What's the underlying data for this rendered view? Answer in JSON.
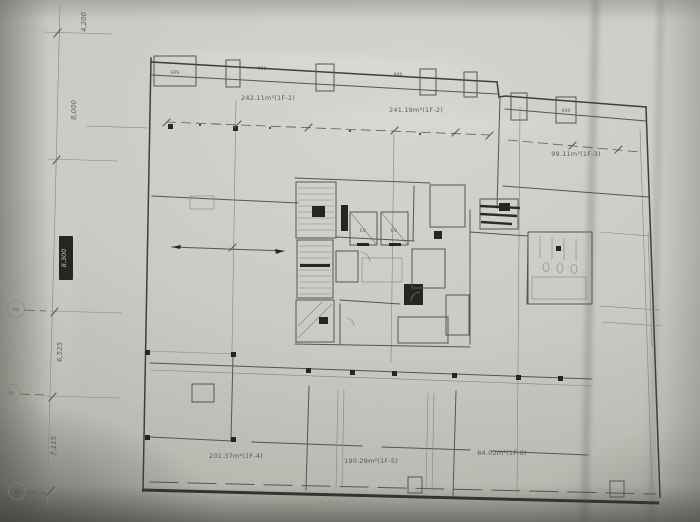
{
  "photo": {
    "paper_color": "#c9cbc4",
    "ink_color": "#45463f",
    "heavy_line_color": "#33342e"
  },
  "left_dimension_string": {
    "labels": [
      "4,200",
      "8,000",
      "8,300",
      "6,525",
      "7,115"
    ]
  },
  "grid_bubbles": [
    "Y3",
    "Y2",
    "Y1"
  ],
  "rooms": {
    "top_left": "242.11m²(1F-1)",
    "top_center": "241.19m²(1F-2)",
    "right_wing": "99.11m²(1F-3)",
    "bottom_left": "201.37m²(1F-4)",
    "bottom_center": "190.29m²(1F-5)",
    "bottom_right": "84.02m²(1F-6)"
  },
  "small_labels": {
    "top_box": "EPS",
    "top_mid": "900",
    "top_right": "900",
    "wing_jamb": "600",
    "elevator_1": "EV",
    "elevator_2": "EV"
  }
}
